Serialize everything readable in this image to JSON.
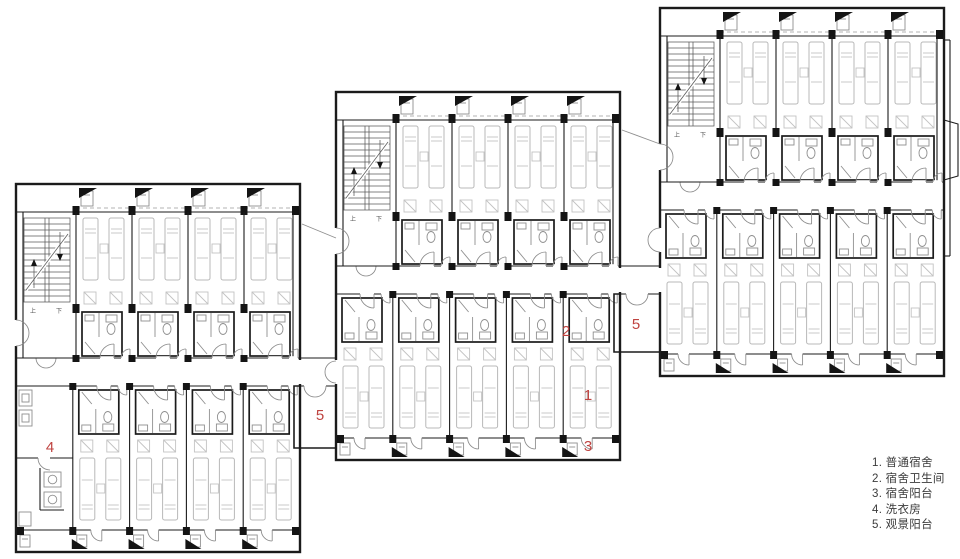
{
  "plan": {
    "type": "architectural-floor-plan",
    "description": "Dormitory floor plan with three staggered residential blocks",
    "wall_color": "#1b1b1b",
    "furniture_color": "#b8b8b8",
    "annotation_color": "#bf4340",
    "stair_up_label": "上",
    "stair_down_label": "下"
  },
  "annotations": [
    {
      "text": "4",
      "x": 50,
      "y": 452
    },
    {
      "text": "5",
      "x": 320,
      "y": 420
    },
    {
      "text": "2",
      "x": 566,
      "y": 336
    },
    {
      "text": "1",
      "x": 588,
      "y": 400
    },
    {
      "text": "3",
      "x": 588,
      "y": 451
    },
    {
      "text": "5",
      "x": 636,
      "y": 329
    }
  ],
  "legend": {
    "items": [
      "1. 普通宿舍",
      "2. 宿舍卫生间",
      "3. 宿舍阳台",
      "4. 洗衣房",
      "5. 观景阳台"
    ]
  }
}
